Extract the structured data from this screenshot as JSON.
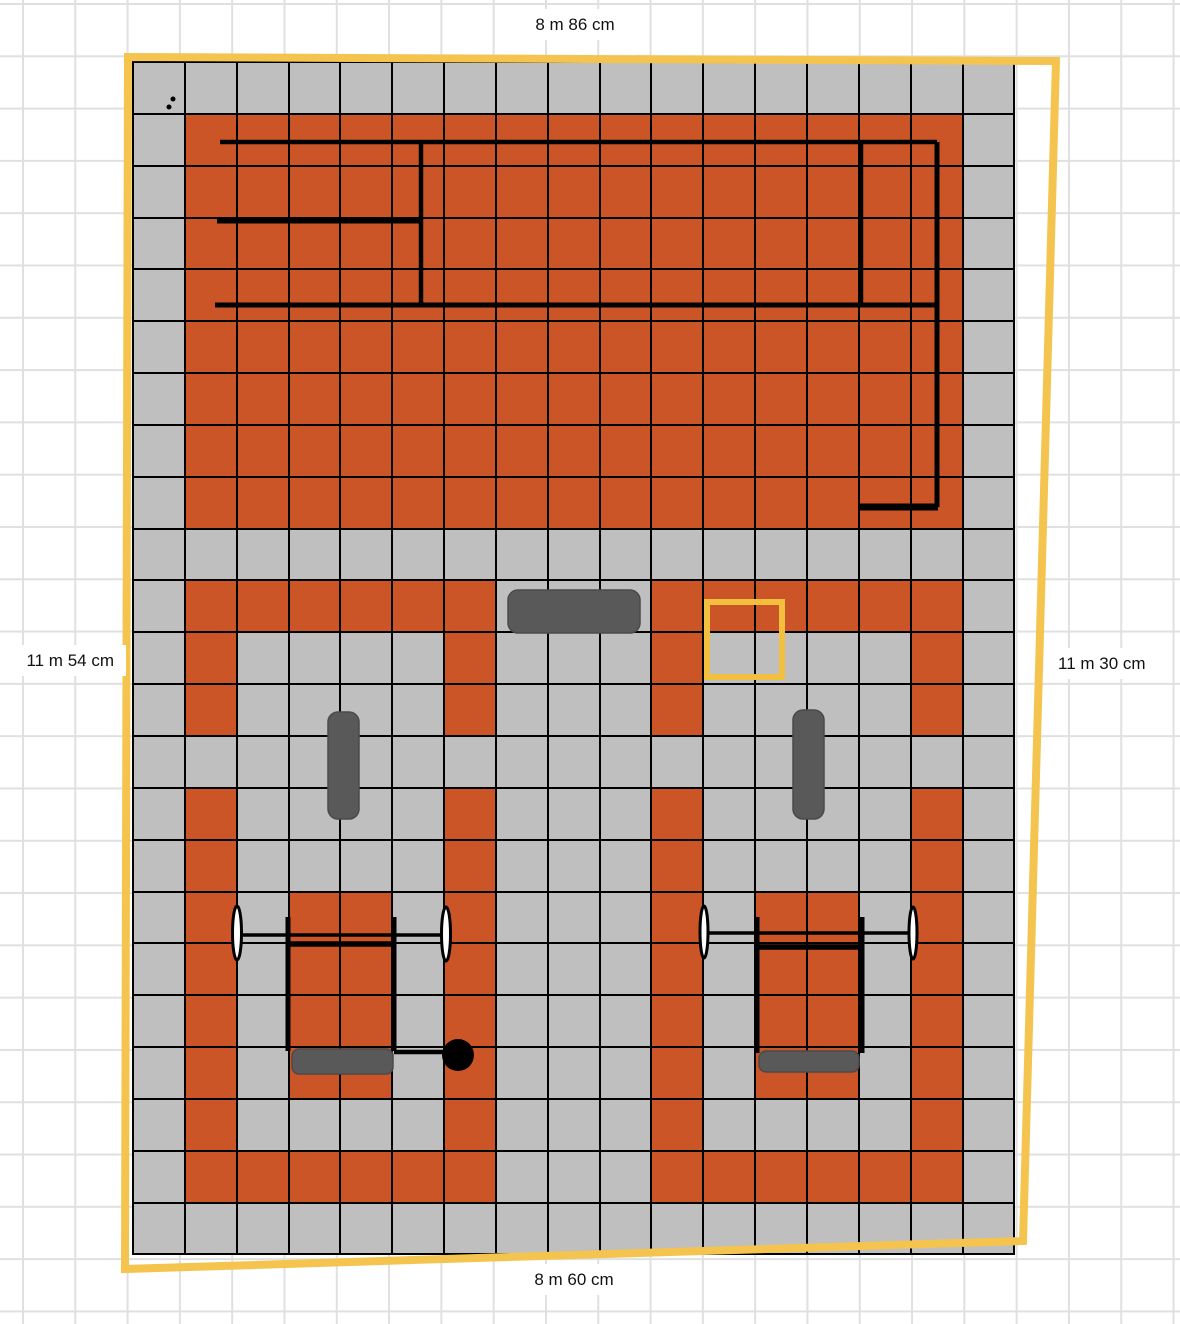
{
  "app": {
    "background": "#ffffff",
    "grid_line_color": "#e0e0e0",
    "grid_pitch": 52.3,
    "grid_offset_x": 22,
    "grid_offset_y": 3
  },
  "dimension_labels": {
    "top": "8 m 86 cm",
    "bottom": "8 m 60 cm",
    "left": "11 m 54 cm",
    "right": "11 m 30 cm"
  },
  "palette": {
    "tile_orange": "#CC5527",
    "tile_gray": "#BFBFBF",
    "tile_border": "#000000",
    "equipment_fill": "#595959",
    "equipment_stroke": "#4a4a4a",
    "plate_fill": "#ffffff",
    "ink": "#000000",
    "highlight_yellow": "#F3BF3E",
    "perimeter_yellow": "#F4C44E"
  },
  "floor": {
    "cols": 17,
    "rows": 23,
    "left": 132,
    "top": 61,
    "cell": 49.85,
    "gap": 2,
    "legend": {
      "O": "orange tile",
      "G": "gray tile"
    },
    "tile_map": [
      "GGGGGGGGGGGGGGGGG",
      "GOOOOOOOOOOOOOOOG",
      "GOOOOOOOOOOOOOOOG",
      "GOOOOOOOOOOOOOOOG",
      "GOOOOOOOOOOOOOOOG",
      "GOOOOOOOOOOOOOOOG",
      "GOOOOOOOOOOOOOOOG",
      "GOOOOOOOOOOOOOOOG",
      "GOOOOOOOOOOOOOOOG",
      "GGGGGGGGGGGGGGGGG",
      "GOOOOOOGGGOOOOOOG",
      "GOGGGGOGGGOGGGGOG",
      "GOGGGGOGGGOGGGGOG",
      "GGGGGGGGGGGGGGGGG",
      "GOGGGGOGGGOGGGGOG",
      "GOGGGGOGGGOGGGGOG",
      "GOGOOGOGGGOGOOGOG",
      "GOGOOGOGGGOGOOGOG",
      "GOGOOGOGGGOGOOGOG",
      "GOGOOGOGGGOGOOGOG",
      "GOGGGGOGGGOGGGGOG",
      "GOOOOOOGGGOOOOOOG",
      "GGGGGGGGGGGGGGGGG"
    ]
  },
  "perimeter": {
    "points": "128,57 1056,61 1023,1241 125,1269",
    "stroke_width": 8
  },
  "highlight_square": {
    "x": 707,
    "y": 602,
    "w": 75,
    "h": 75,
    "stroke_width": 6
  },
  "equipment": {
    "lines": [
      {
        "name": "rig-back-line",
        "x1": 220,
        "y1": 142,
        "x2": 937,
        "y2": 142,
        "w": 4.5
      },
      {
        "name": "rig-shelf-line",
        "x1": 217,
        "y1": 221,
        "x2": 421,
        "y2": 221,
        "w": 5
      },
      {
        "name": "rig-front-line",
        "x1": 215,
        "y1": 305,
        "x2": 935,
        "y2": 305,
        "w": 5
      },
      {
        "name": "rig-upright-left",
        "x1": 421,
        "y1": 142,
        "x2": 421,
        "y2": 305,
        "w": 4.5
      },
      {
        "name": "rig-upright-mid",
        "x1": 861,
        "y1": 142,
        "x2": 861,
        "y2": 305,
        "w": 4.5
      },
      {
        "name": "rig-side-rail",
        "x1": 937,
        "y1": 142,
        "x2": 937,
        "y2": 507,
        "w": 5
      },
      {
        "name": "rig-foot",
        "x1": 858,
        "y1": 507,
        "x2": 938,
        "y2": 507,
        "w": 7
      },
      {
        "name": "barbell-bar-left",
        "x1": 237,
        "y1": 935,
        "x2": 446,
        "y2": 935,
        "w": 3.5
      },
      {
        "name": "rack-upright",
        "x1": 288,
        "y1": 917,
        "x2": 288,
        "y2": 1051,
        "w": 5
      },
      {
        "name": "rack-upright",
        "x1": 394,
        "y1": 917,
        "x2": 394,
        "y2": 1051,
        "w": 5
      },
      {
        "name": "rack-crossbar",
        "x1": 286,
        "y1": 944,
        "x2": 396,
        "y2": 944,
        "w": 5.5
      },
      {
        "name": "ball-connector",
        "x1": 394,
        "y1": 1052,
        "x2": 444,
        "y2": 1052,
        "w": 4.5
      },
      {
        "name": "barbell-bar-right",
        "x1": 704,
        "y1": 933,
        "x2": 913,
        "y2": 933,
        "w": 3.5
      },
      {
        "name": "rack-upright",
        "x1": 757,
        "y1": 917,
        "x2": 757,
        "y2": 1053,
        "w": 5
      },
      {
        "name": "rack-upright",
        "x1": 862,
        "y1": 917,
        "x2": 862,
        "y2": 1053,
        "w": 5
      },
      {
        "name": "rack-crossbar",
        "x1": 755,
        "y1": 947,
        "x2": 864,
        "y2": 947,
        "w": 5.5
      }
    ],
    "rects": [
      {
        "name": "table-top",
        "x": 508,
        "y": 590,
        "w": 132,
        "h": 43,
        "rx": 10
      },
      {
        "name": "bench-left",
        "x": 328,
        "y": 712,
        "w": 31,
        "h": 107,
        "rx": 10
      },
      {
        "name": "bench-right",
        "x": 793,
        "y": 710,
        "w": 31,
        "h": 109,
        "rx": 10
      },
      {
        "name": "seat-left",
        "x": 292,
        "y": 1049,
        "w": 101,
        "h": 25,
        "rx": 7
      },
      {
        "name": "seat-right",
        "x": 759,
        "y": 1051,
        "w": 100,
        "h": 21,
        "rx": 7
      }
    ],
    "ellipses": [
      {
        "name": "barbell-plate",
        "cx": 237,
        "cy": 933,
        "rx": 4.5,
        "ry": 27
      },
      {
        "name": "barbell-plate",
        "cx": 446,
        "cy": 934,
        "rx": 4.5,
        "ry": 27
      },
      {
        "name": "barbell-plate",
        "cx": 704,
        "cy": 932,
        "rx": 4,
        "ry": 26
      },
      {
        "name": "barbell-plate",
        "cx": 913,
        "cy": 933,
        "rx": 4,
        "ry": 26
      }
    ],
    "circles": [
      {
        "name": "medicine-ball",
        "cx": 458,
        "cy": 1055,
        "r": 16,
        "filled": true
      },
      {
        "name": "marker-dot",
        "cx": 173,
        "cy": 99,
        "r": 2.5,
        "filled": true
      },
      {
        "name": "marker-dot",
        "cx": 169,
        "cy": 107,
        "r": 2.5,
        "filled": true
      }
    ]
  }
}
